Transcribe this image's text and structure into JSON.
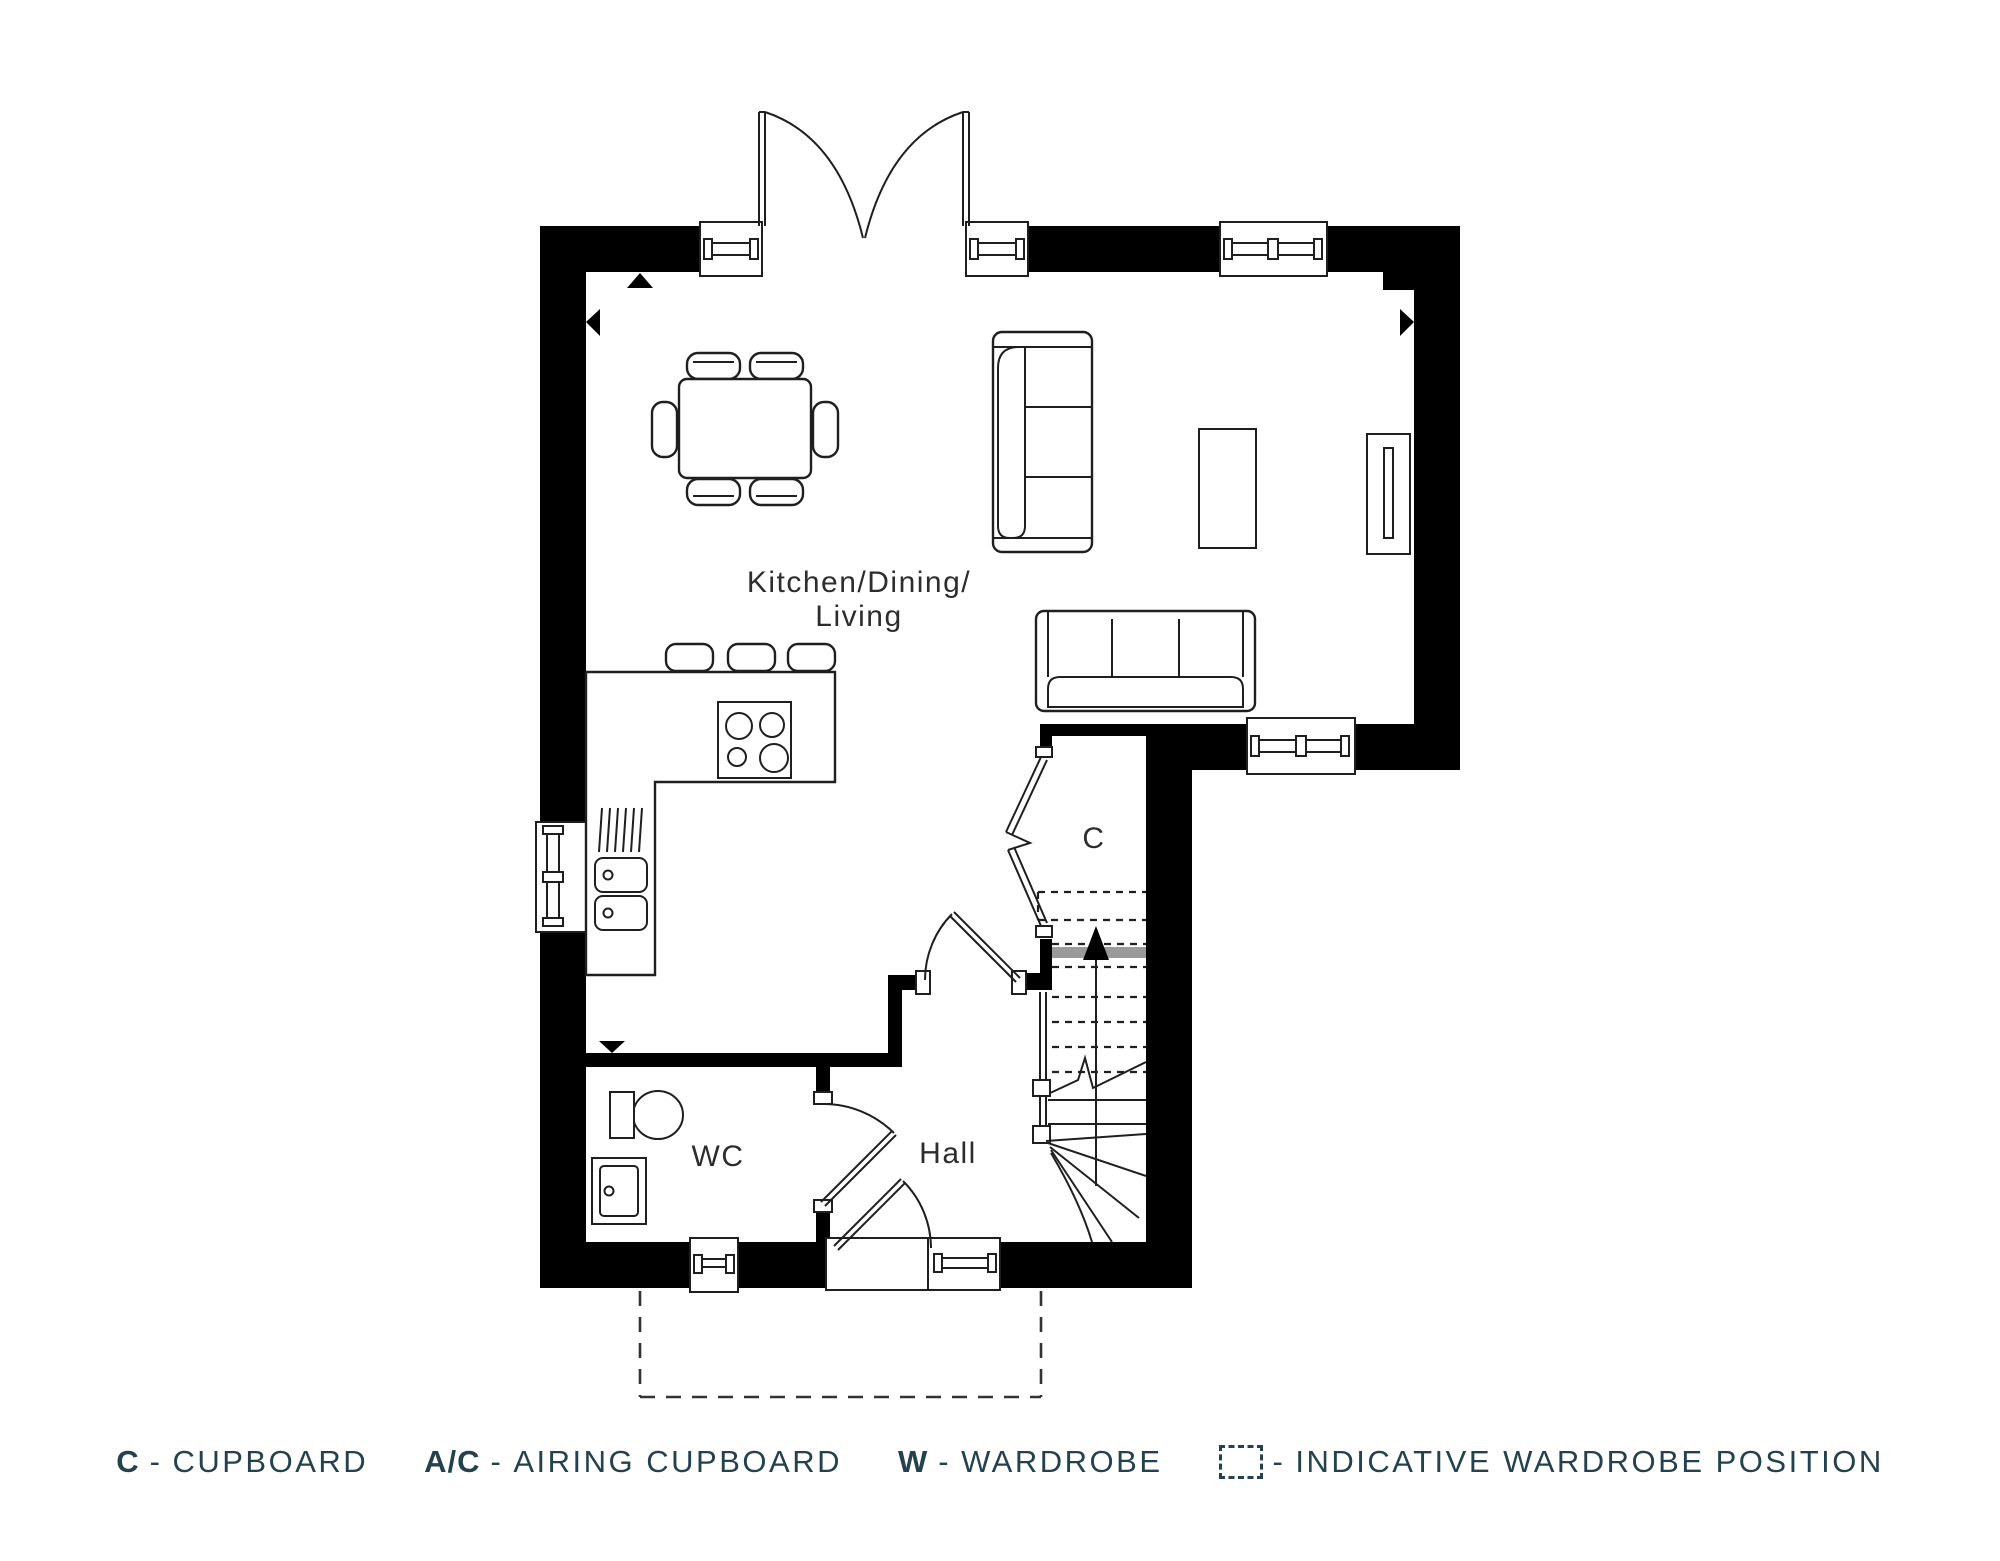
{
  "plan": {
    "rooms": {
      "kitchen_line1": "Kitchen/Dining/",
      "kitchen_line2": "Living",
      "hall": "Hall",
      "wc": "WC",
      "cupboard": "C"
    },
    "stairs_direction": "up"
  },
  "legend": {
    "dash": "-",
    "items": [
      {
        "abbr": "C",
        "label": "CUPBOARD"
      },
      {
        "abbr": "A/C",
        "label": "AIRING CUPBOARD"
      },
      {
        "abbr": "W",
        "label": "WARDROBE"
      }
    ],
    "indicative": {
      "label": "INDICATIVE WARDROBE POSITION",
      "icon": "dashed-box"
    }
  },
  "colors": {
    "background": "#ffffff",
    "wall": "#000000",
    "line": "#1f1f1f",
    "landing_gray": "#9a9a9a",
    "label_text": "#2d2d2d",
    "legend_text": "#24424d"
  }
}
